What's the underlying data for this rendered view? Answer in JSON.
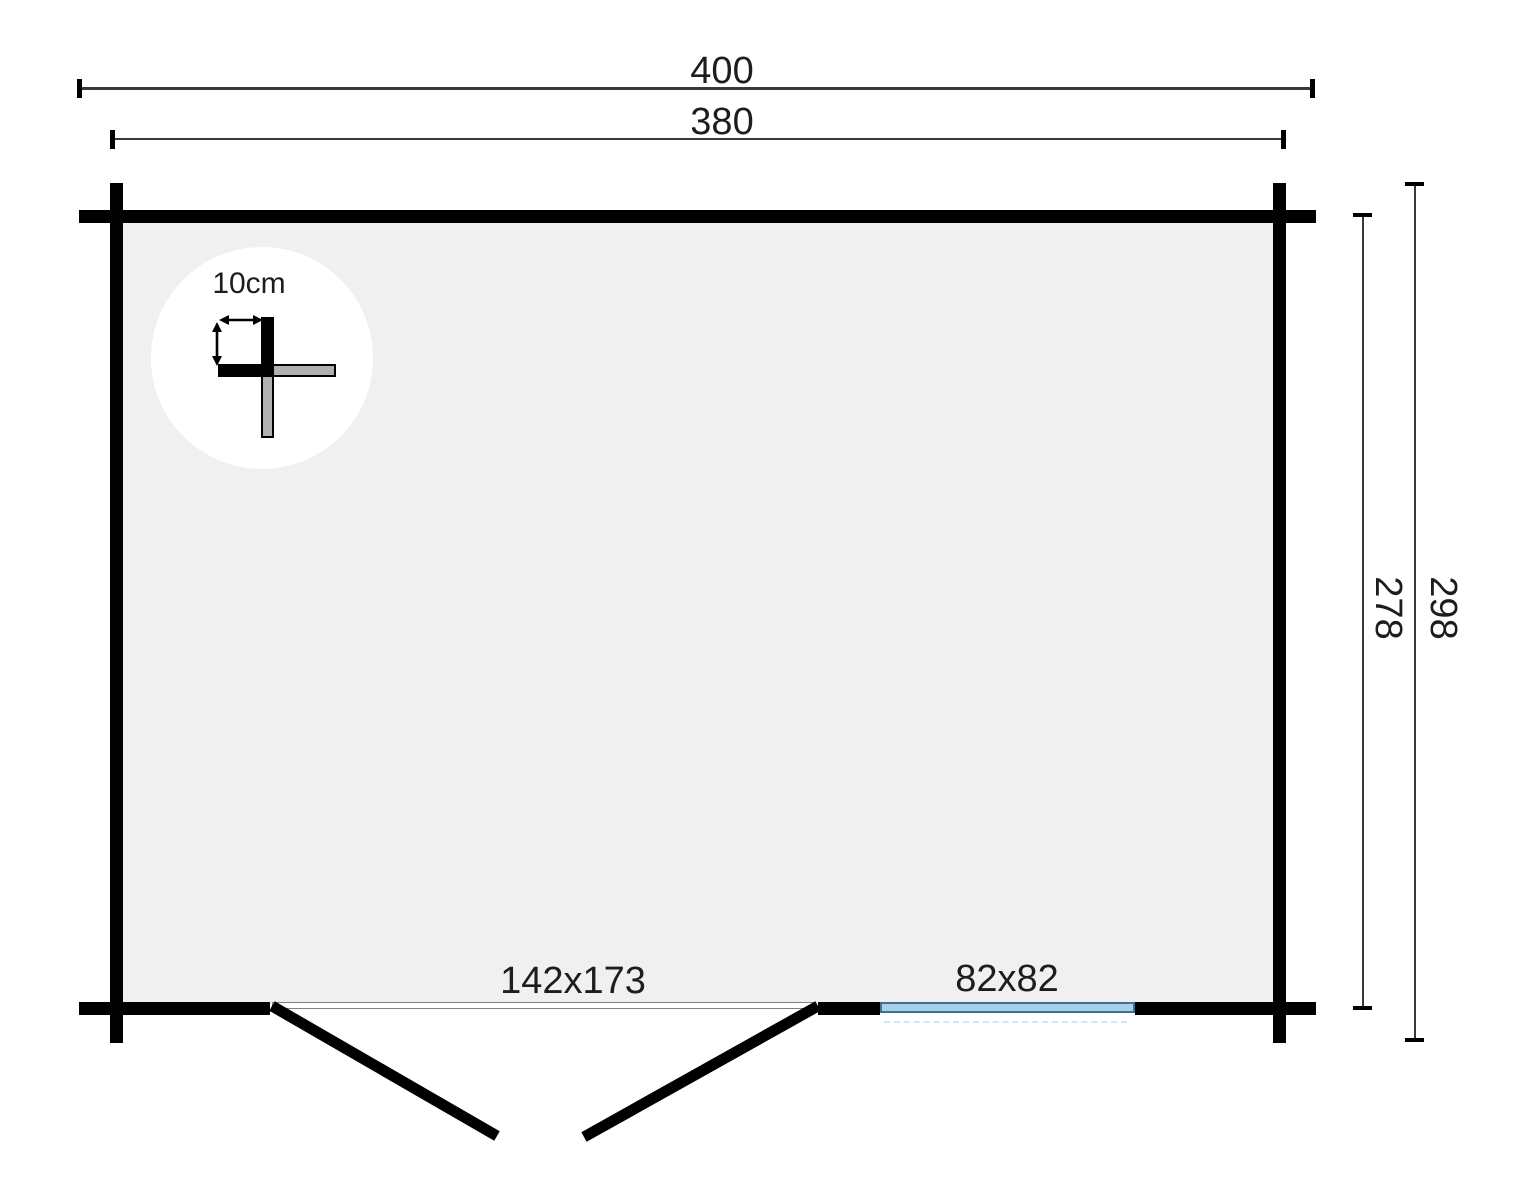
{
  "diagram": {
    "type": "cabin-floor-plan",
    "labels": {
      "outer_width": "400",
      "inner_width": "380",
      "outer_depth": "298",
      "inner_depth": "278",
      "door_size": "142x173",
      "window_size": "82x82",
      "wall_thickness": "10cm"
    },
    "icons": {
      "width_arrow": "double-headed-horizontal-arrow",
      "height_arrow": "double-headed-vertical-arrow"
    },
    "colors": {
      "wall": "#000000",
      "interior_fill": "#f0f0f0",
      "detail_circle_fill": "#ffffff",
      "log_gray": "#b0b0b0",
      "window_fill": "#a5d2ea",
      "window_border": "#4a6e84",
      "dimension_line": "#3a3a3a",
      "text": "#1d1d1b",
      "background": "#ffffff"
    }
  }
}
